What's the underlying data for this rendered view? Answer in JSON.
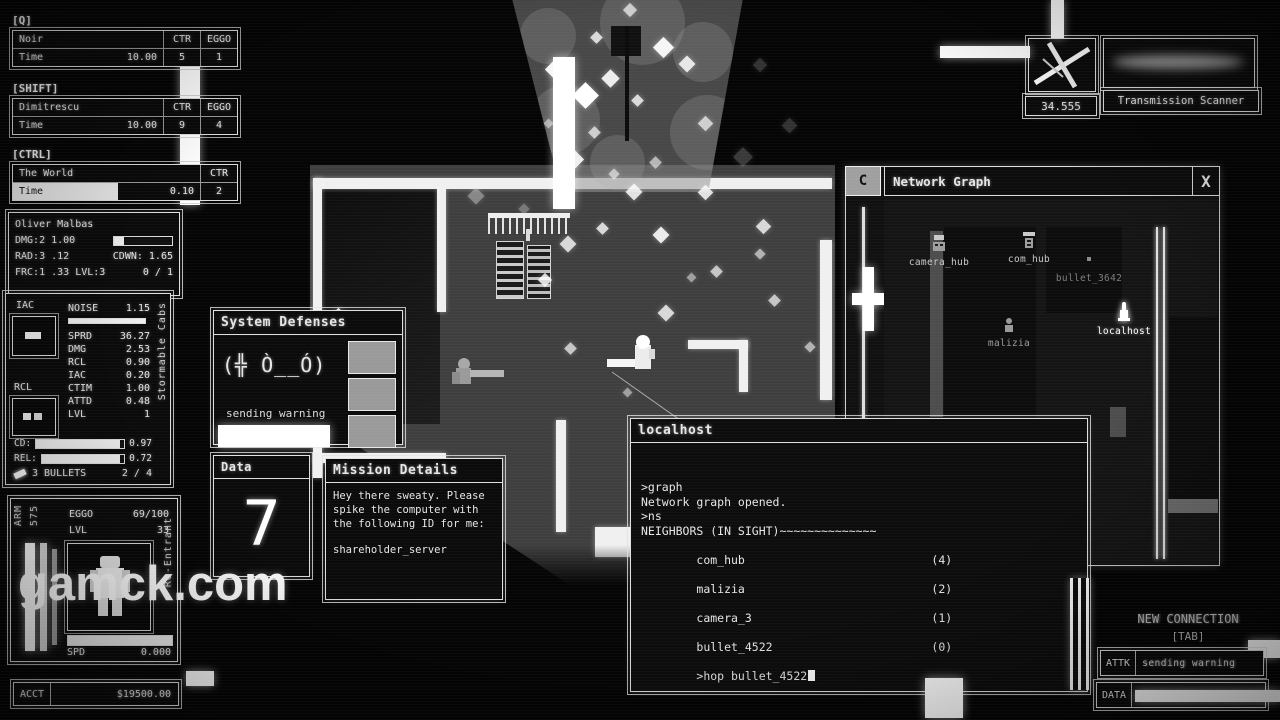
{
  "watermark": "gamck.com",
  "colors": {
    "accent": "#ffffff",
    "floor": "#3f3f3f",
    "panel_bg": "#0b0b0b",
    "defense_box": "#9a9a9a"
  },
  "abilities": [
    {
      "key": "[Q]",
      "name": "Noir",
      "c1": "CTR",
      "c2": "EGGO",
      "tlabel": "Time",
      "tvalue": "10.00",
      "v1": "5",
      "v2": "1"
    },
    {
      "key": "[SHIFT]",
      "name": "Dimitrescu",
      "c1": "CTR",
      "c2": "EGGO",
      "tlabel": "Time",
      "tvalue": "10.00",
      "v1": "9",
      "v2": "4"
    },
    {
      "key": "[CTRL]",
      "name": "The World",
      "c1": "CTR",
      "tlabel": "Time",
      "tvalue": "0.10",
      "v1": "2"
    }
  ],
  "player_card": {
    "name": "Oliver Malbas",
    "l1": "DMG:2 1.00",
    "l2a": "RAD:3 .12",
    "l2b": "CDWN: 1.65",
    "l3a": "FRC:1 .33 LVL:3",
    "l3b": "0 / 1"
  },
  "weapon_panel": {
    "slot1": "IAC",
    "slot2": "RCL",
    "noise_label": "NOISE",
    "noise_value": "1.15",
    "stats": [
      {
        "label": "SPRD",
        "value": "36.27"
      },
      {
        "label": "DMG",
        "value": "2.53"
      },
      {
        "label": "RCL",
        "value": "0.90"
      },
      {
        "label": "IAC",
        "value": "0.20"
      },
      {
        "label": "CTIM",
        "value": "1.00"
      },
      {
        "label": "ATTD",
        "value": "0.48"
      },
      {
        "label": "LVL",
        "value": "1"
      }
    ],
    "cd_label": "CD:",
    "cd_value": "0.97",
    "rel_label": "REL:",
    "rel_value": "0.72",
    "ammo_count": "3",
    "ammo_label": "BULLETS",
    "ammo_frac": "2 / 4",
    "side_label": "Stormable Cabs"
  },
  "char_panel": {
    "arm_label": "ARM",
    "arm_value": "575",
    "eggo_label": "EGGO",
    "eggo_value": "69/100",
    "lvl_label": "LVL",
    "lvl_value": "33",
    "spd_label": "SPD",
    "spd_value": "0.000",
    "side_label": "Re-Entrant"
  },
  "account": {
    "label": "ACCT",
    "value": "$19500.00"
  },
  "system_defenses": {
    "title": "System Defenses",
    "face": "(╬ Ò__Ó)",
    "status": "sending warning"
  },
  "data_panel": {
    "title": "Data",
    "value": "7"
  },
  "mission": {
    "title": "Mission Details",
    "body": "Hey there sweaty. Please spike the computer with the following ID for me:",
    "target": "shareholder_server"
  },
  "terminal": {
    "title": "localhost",
    "lines": [
      ">graph",
      "Network graph opened.",
      ">ns",
      "NEIGHBORS (IN SIGHT)~~~~~~~~~~~~~~"
    ],
    "neighbors": [
      {
        "name": "com_hub",
        "count": "(4)"
      },
      {
        "name": "malizia",
        "count": "(2)"
      },
      {
        "name": "camera_3",
        "count": "(1)"
      },
      {
        "name": "bullet_4522",
        "count": "(0)"
      }
    ],
    "prompt": ">hop bullet_4522"
  },
  "network_graph": {
    "corner": "C",
    "title": "Network Graph",
    "close": "X",
    "zoom": "3.7X",
    "nodes": [
      {
        "name": "camera_hub"
      },
      {
        "name": "com_hub"
      },
      {
        "name": "bullet_3642"
      },
      {
        "name": "malizia"
      },
      {
        "name": "localhost"
      }
    ]
  },
  "scanner": {
    "value": "34.555",
    "label": "Transmission Scanner"
  },
  "connection": {
    "header": "NEW CONNECTION",
    "key": "[TAB]",
    "attk_label": "ATTK",
    "attk_value": "sending warning",
    "data_label": "DATA",
    "data_value": "7"
  },
  "game": {
    "particles": [
      [
        548,
        62,
        15,
        0.95
      ],
      [
        576,
        86,
        19,
        1
      ],
      [
        604,
        72,
        13,
        0.9
      ],
      [
        633,
        96,
        9,
        0.8
      ],
      [
        656,
        40,
        15,
        0.95
      ],
      [
        681,
        58,
        12,
        0.85
      ],
      [
        590,
        128,
        9,
        0.7
      ],
      [
        566,
        152,
        15,
        0.9
      ],
      [
        610,
        170,
        8,
        0.6
      ],
      [
        628,
        186,
        12,
        0.85
      ],
      [
        651,
        158,
        9,
        0.6
      ],
      [
        700,
        118,
        11,
        0.7
      ],
      [
        592,
        33,
        9,
        0.8
      ],
      [
        545,
        120,
        7,
        0.5
      ],
      [
        625,
        5,
        10,
        0.7
      ],
      [
        540,
        275,
        10,
        0.85
      ],
      [
        566,
        344,
        9,
        0.7
      ],
      [
        598,
        224,
        9,
        0.8
      ],
      [
        655,
        229,
        12,
        0.9
      ],
      [
        700,
        187,
        11,
        0.85
      ],
      [
        712,
        267,
        9,
        0.7
      ],
      [
        758,
        221,
        11,
        0.8
      ],
      [
        770,
        296,
        9,
        0.7
      ],
      [
        806,
        343,
        8,
        0.6
      ],
      [
        333,
        310,
        11,
        0.9
      ],
      [
        624,
        389,
        7,
        0.5
      ],
      [
        660,
        307,
        12,
        0.8
      ],
      [
        688,
        274,
        7,
        0.5
      ],
      [
        756,
        250,
        8,
        0.6
      ],
      [
        562,
        238,
        12,
        0.8
      ],
      [
        736,
        150,
        14,
        0.35,
        "#9a9a9a"
      ],
      [
        784,
        120,
        11,
        0.3,
        "#9a9a9a"
      ],
      [
        755,
        60,
        10,
        0.3,
        "#9a9a9a"
      ],
      [
        470,
        190,
        12,
        0.5,
        "#cfcfcf"
      ],
      [
        520,
        205,
        8,
        0.4,
        "#cfcfcf"
      ]
    ]
  }
}
